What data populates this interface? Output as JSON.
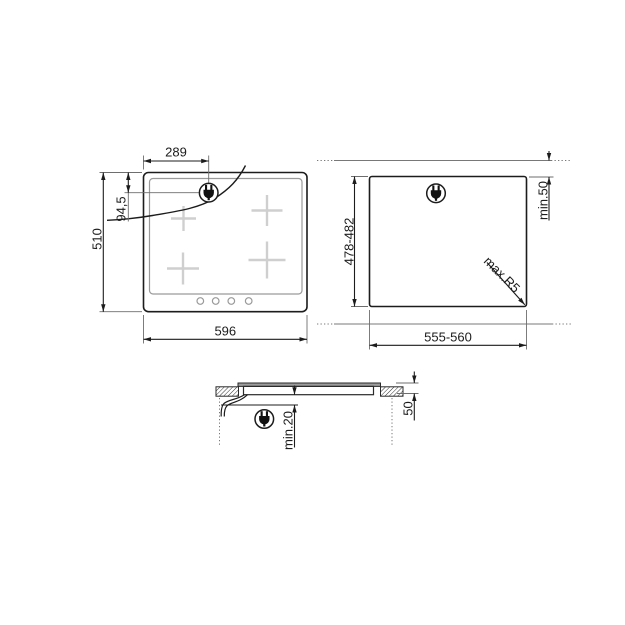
{
  "views": {
    "top": {
      "dim_plug_x": "289",
      "dim_plug_y": "94,5",
      "dim_height": "510",
      "dim_width": "596"
    },
    "cutout": {
      "dim_height": "478-482",
      "dim_width": "555-560",
      "dim_rear_clearance": "min.50",
      "dim_corner_radius": "max.R5"
    },
    "section": {
      "dim_bottom_clearance": "min.20",
      "dim_depth": "50"
    },
    "icons": {
      "plug": "power-plug-icon"
    },
    "colors": {
      "line": "#1c1c1c",
      "thin_line": "#6e6e6e",
      "worktop_edge_line": "#787878",
      "burner_cross": "#cfcfcf",
      "knob_stroke": "#9a9a9a",
      "glass_fill": "#9c9c9c",
      "background": "#ffffff"
    }
  }
}
